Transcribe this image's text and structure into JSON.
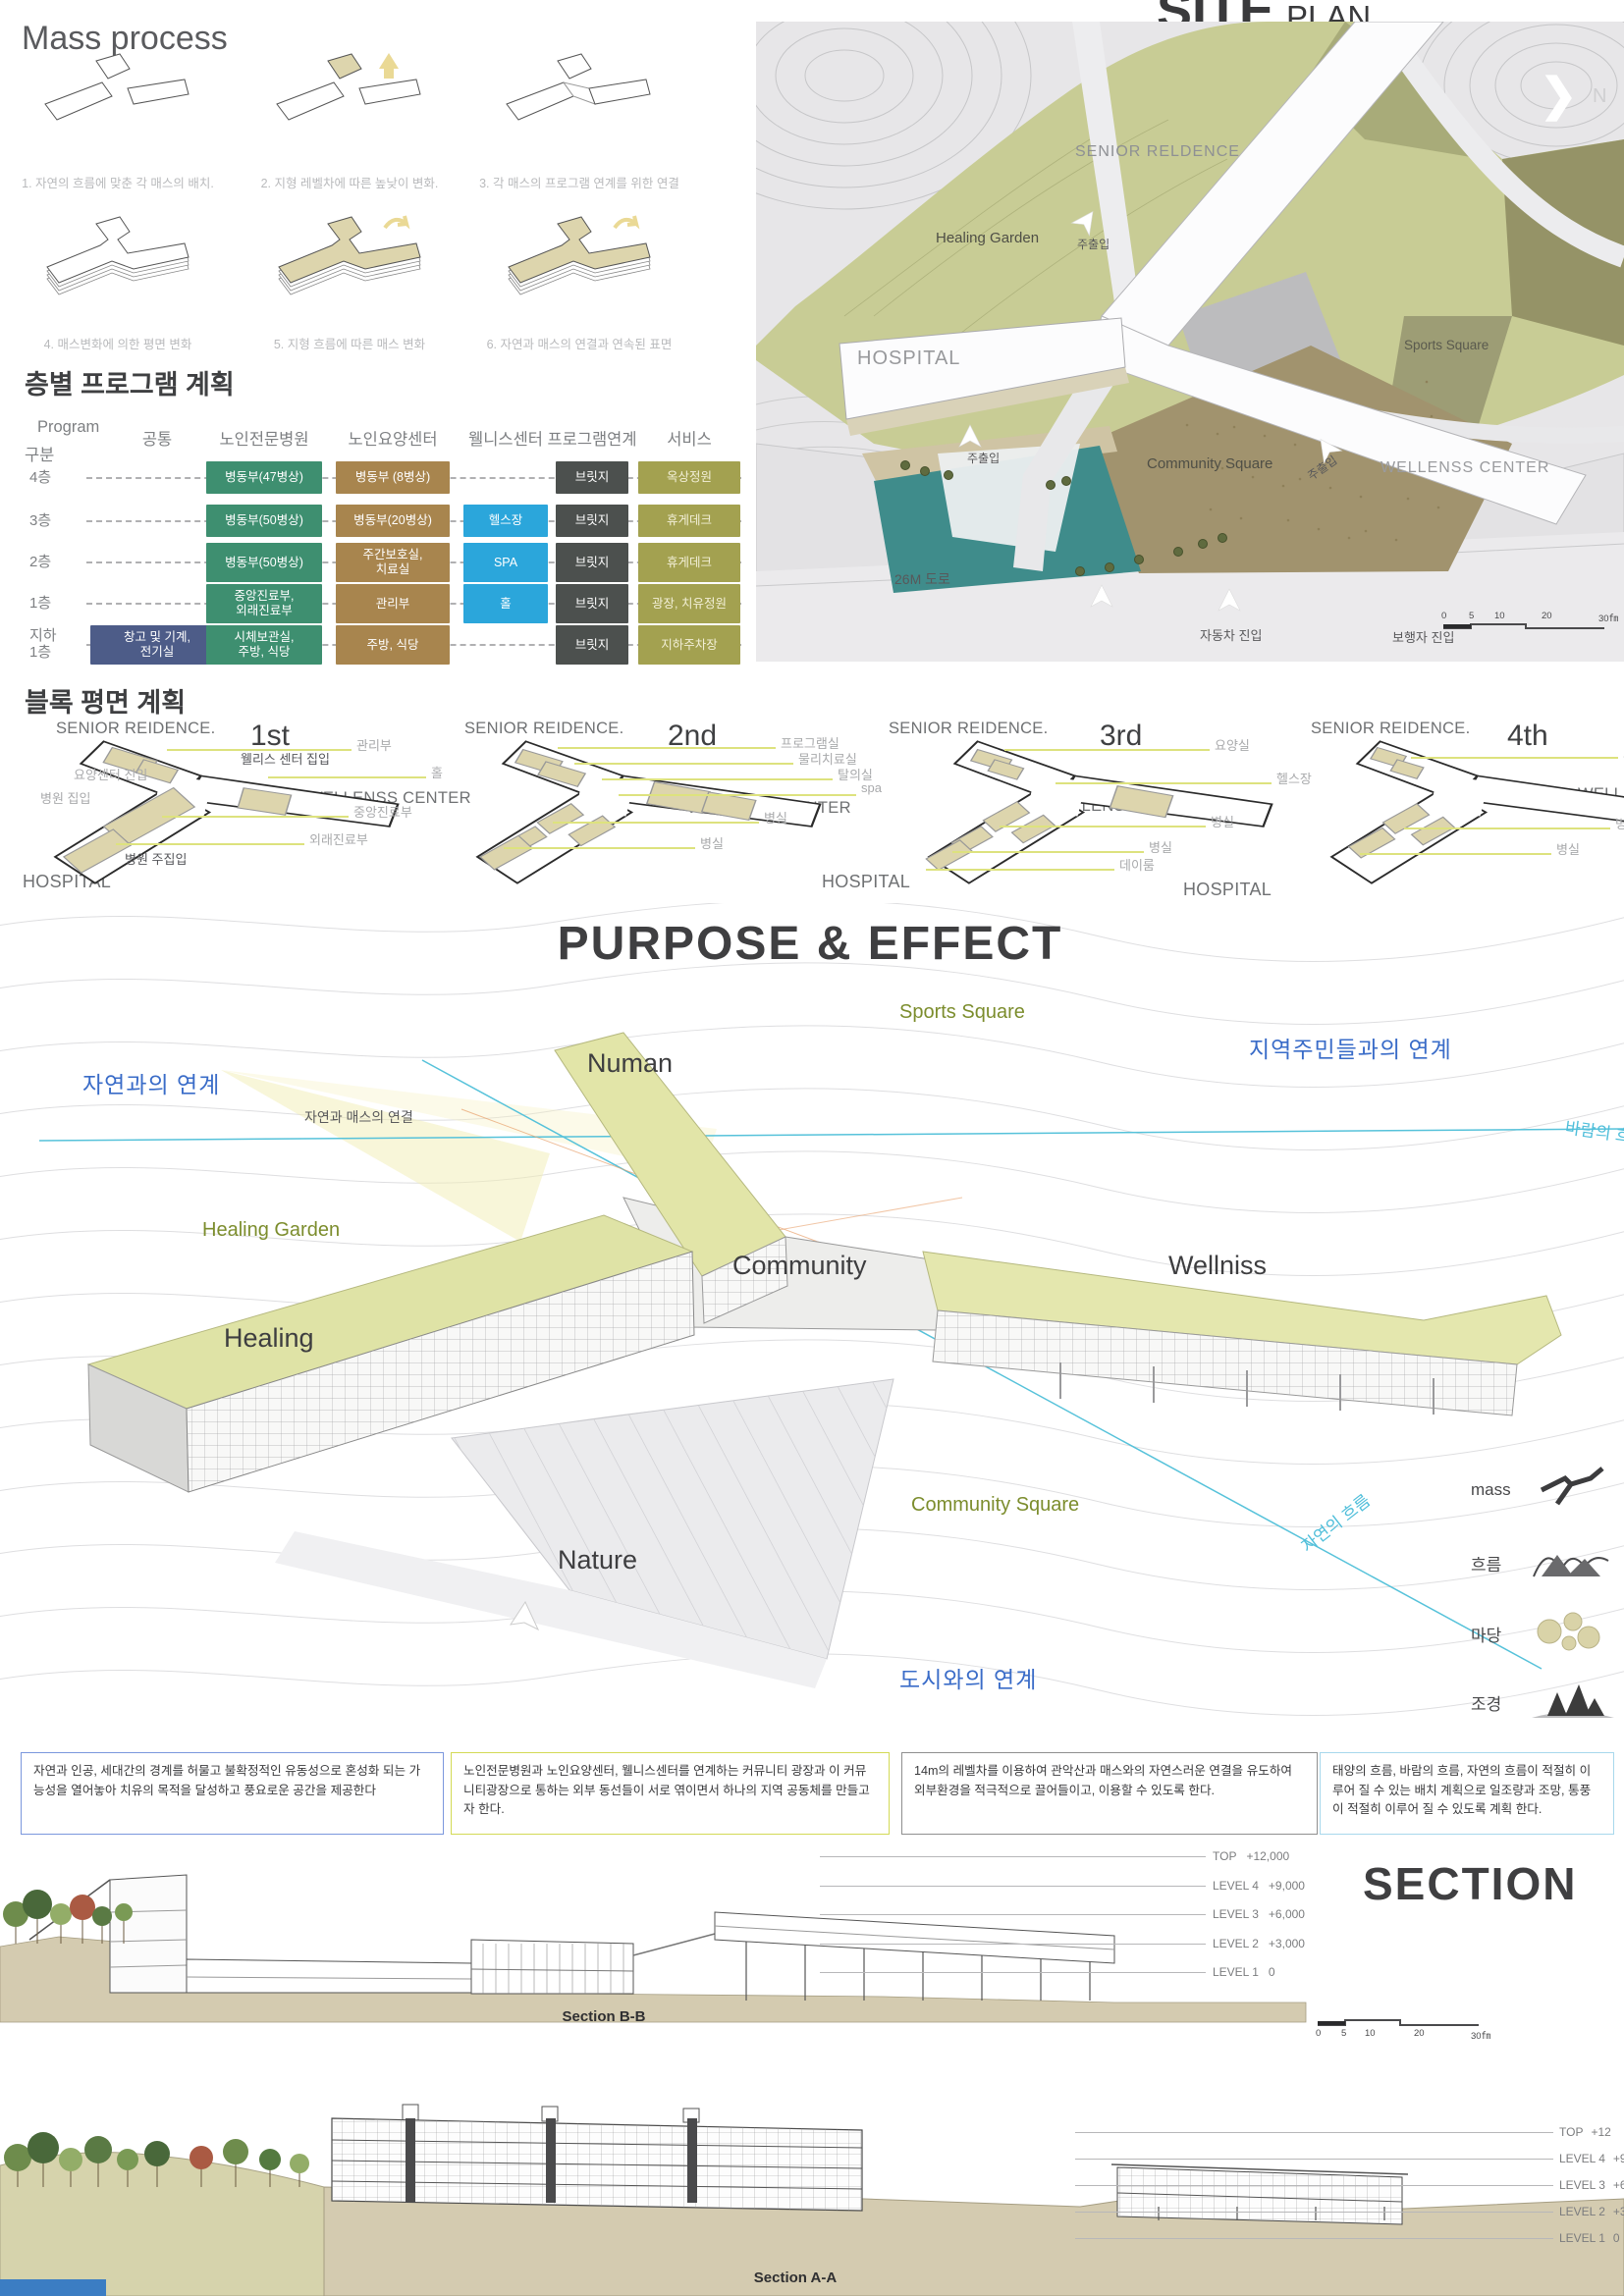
{
  "colors": {
    "green": "#3E8F70",
    "brown": "#A8854E",
    "blue": "#2BA6DB",
    "dark": "#4C504E",
    "olive": "#A3A150",
    "navy": "#4D5C88",
    "callout_line": "#dde27e",
    "accent_blue": "#3a6cc8",
    "accent_cyan": "#4fbeda",
    "accent_olive": "#7c8d2d",
    "ground_tan": "#d4cbb0",
    "pond_teal": "#3f8c8b"
  },
  "mass_process": {
    "title": "Mass process",
    "captions": [
      "1. 자연의 흐름에 맞춘 각 매스의 배치.",
      "2. 지형 레벨차에 따른 높낮이 변화.",
      "3. 각 매스의 프로그램 연계를 위한 연결",
      "4. 매스변화에 의한 평면 변화",
      "5. 지형 흐름에 따른 매스 변화",
      "6. 자연과 매스의 연결과 연속된 표면"
    ]
  },
  "floor_program": {
    "title": "층별 프로그램 계획",
    "program_label": "Program",
    "gubun_label": "구분",
    "headers": [
      "공통",
      "노인전문병원",
      "노인요양센터",
      "웰니스센터",
      "프로그램연계",
      "서비스"
    ],
    "rows": [
      {
        "floor": "4층",
        "cells": [
          {
            "col": "hospital",
            "text": "병동부(47병상)"
          },
          {
            "col": "care",
            "text": "병동부 (8병상)"
          },
          {
            "col": "link",
            "text": "브릿지"
          },
          {
            "col": "service",
            "text": "옥상정원"
          }
        ]
      },
      {
        "floor": "3층",
        "cells": [
          {
            "col": "hospital",
            "text": "병동부(50병상)"
          },
          {
            "col": "care",
            "text": "병동부(20병상)"
          },
          {
            "col": "wellness",
            "text": "헬스장"
          },
          {
            "col": "link",
            "text": "브릿지"
          },
          {
            "col": "service",
            "text": "휴게데크"
          }
        ]
      },
      {
        "floor": "2층",
        "cells": [
          {
            "col": "hospital",
            "text": "병동부(50병상)"
          },
          {
            "col": "care",
            "text": "주간보호실,\n치료실"
          },
          {
            "col": "wellness",
            "text": "SPA"
          },
          {
            "col": "link",
            "text": "브릿지"
          },
          {
            "col": "service",
            "text": "휴게데크"
          }
        ]
      },
      {
        "floor": "1층",
        "cells": [
          {
            "col": "hospital",
            "text": "중앙진료부,\n외래진료부"
          },
          {
            "col": "care",
            "text": "관리부"
          },
          {
            "col": "wellness",
            "text": "홀"
          },
          {
            "col": "link",
            "text": "브릿지"
          },
          {
            "col": "service",
            "text": "광장, 치유정원"
          }
        ]
      },
      {
        "floor": "지하\n1층",
        "cells": [
          {
            "col": "common",
            "text": "창고 및 기계,\n전기실"
          },
          {
            "col": "hospital",
            "text": "시체보관실,\n주방, 식당"
          },
          {
            "col": "care",
            "text": "주방, 식당"
          },
          {
            "col": "link",
            "text": "브릿지"
          },
          {
            "col": "service",
            "text": "지하주차장"
          }
        ]
      }
    ]
  },
  "site_plan": {
    "title_bold": "SITE",
    "title_light": "PLAN",
    "north": "N",
    "labels": [
      "SENIOR RELDENCE",
      "Healing Garden",
      "HOSPITAL",
      "Sports Square",
      "Community Square",
      "WELLENSS CENTER",
      "주출입",
      "주출입",
      "주출입",
      "26M 도로",
      "자동차 진입",
      "보행자 진입"
    ],
    "scale": [
      "0",
      "5",
      "10",
      "20",
      "30㎙"
    ]
  },
  "block_plans": {
    "title": "블록 평면 계획",
    "plans": [
      {
        "name": "1st",
        "senior": "SENIOR REIDENCE.",
        "wellness": "WELLENSS CENTER",
        "hospital": "HOSPITAL",
        "callouts": [
          "관리부",
          "웰리스 센터 집입",
          "홀",
          "중앙진료부",
          "외래진료부",
          "요양센터 진입",
          "병원 집입",
          "병원 주집입"
        ]
      },
      {
        "name": "2nd",
        "senior": "SENIOR REIDENCE.",
        "wellness": "WELLENSS CENTER",
        "hospital": "HOSPITAL",
        "callouts": [
          "프로그램실",
          "물리치료실",
          "탈의실",
          "spa",
          "병실",
          "병실"
        ]
      },
      {
        "name": "3rd",
        "senior": "SENIOR REIDENCE.",
        "wellness": "WELLENSS CENTER",
        "hospital": "HOSPITAL",
        "callouts": [
          "요양실",
          "헬스장",
          "병실",
          "병실",
          "데이룸"
        ]
      },
      {
        "name": "4th",
        "senior": "SENIOR REIDENCE.",
        "wellness": "WELLENSS CENTER",
        "hospital": "",
        "callouts": [
          "요양실",
          "병실",
          "병실"
        ]
      }
    ]
  },
  "purpose": {
    "title": "PURPOSE & EFFECT",
    "labels": [
      "자연과의 연계",
      "자연과 매스의 연결",
      "Numan",
      "Sports Square",
      "지역주민들과의 연계",
      "바람의 흐름",
      "Healing Garden",
      "Community",
      "Wellniss",
      "Healing",
      "Community Square",
      "Nature",
      "자연의 흐름",
      "도시와의 연계"
    ],
    "legend": [
      {
        "label": "mass"
      },
      {
        "label": "흐름"
      },
      {
        "label": "마당"
      },
      {
        "label": "조경"
      }
    ]
  },
  "notes": [
    {
      "text": "자연과 인공, 세대간의 경계를 허물고 불확정적인 유동성으로 혼성화 되는 가능성을 열어놓아 치유의 목적을 달성하고 풍요로운 공간을 제공한다",
      "border": "#7b97dd"
    },
    {
      "text": "노인전문병원과 노인요양센터, 웰니스센터를 연계하는 커뮤니티 광장과 이 커뮤니티광장으로 통하는 외부 동선들이 서로 엮이면서 하나의 지역 공동체를 만들고자 한다.",
      "border": "#d3da55"
    },
    {
      "text": "14m의 레벨차를 이용하여 관악산과 매스와의 자연스러운 연결을 유도하여 외부환경을 적극적으로 끌어들이고, 이용할 수 있도록 한다.",
      "border": "#8f8f8f"
    },
    {
      "text": "태양의 흐름, 바람의 흐름, 자연의 흐름이 적절히 이루어 질 수 있는 배치 계획으로 일조량과 조망, 통풍이 적절히 이루어 질 수 있도록 계획 한다.",
      "border": "#a8d8ec"
    }
  ],
  "sections": {
    "bb": {
      "big_title": "SECTION",
      "label": "Section B-B",
      "levels": [
        {
          "name": "TOP",
          "value": "+12,000"
        },
        {
          "name": "LEVEL 4",
          "value": "+9,000"
        },
        {
          "name": "LEVEL 3",
          "value": "+6,000"
        },
        {
          "name": "LEVEL 2",
          "value": "+3,000"
        },
        {
          "name": "LEVEL 1",
          "value": "0"
        }
      ],
      "scale": [
        "0",
        "5",
        "10",
        "20",
        "30㎙"
      ]
    },
    "aa": {
      "label": "Section A-A",
      "levels": [
        {
          "name": "TOP",
          "value": "+12"
        },
        {
          "name": "LEVEL 4",
          "value": "+9,0"
        },
        {
          "name": "LEVEL 3",
          "value": "+6,0"
        },
        {
          "name": "LEVEL 2",
          "value": "+3,0"
        },
        {
          "name": "LEVEL 1",
          "value": "0"
        }
      ]
    }
  }
}
